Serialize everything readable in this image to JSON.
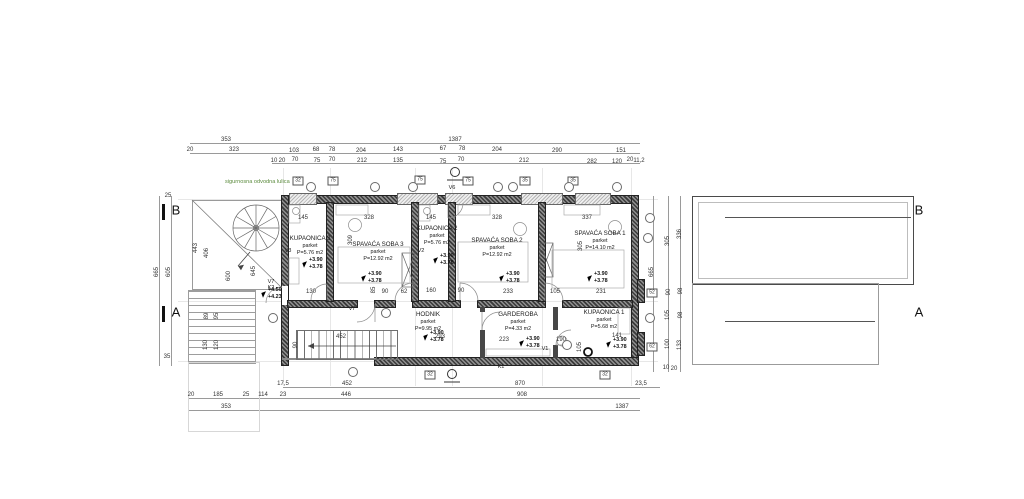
{
  "annotations": {
    "note": "sigurnosna odvodna lulica",
    "note_color": "#5a8a3c"
  },
  "colors": {
    "wall_hatch_dark": "#3b3b3b",
    "wall_hatch_light": "#909090",
    "dimension_text": "#333333",
    "axis_line": "#e7e7e7",
    "note_green": "#5a8a3c"
  },
  "rooms": [
    {
      "name": "KUPAONICA 3",
      "floor": "parket",
      "area": "P=5.76 m2",
      "cx": 310,
      "y": 236
    },
    {
      "name": "SPAVAĆA SOBA 3",
      "floor": "parket",
      "area": "P=12.92 m2",
      "cx": 378,
      "y": 242
    },
    {
      "name": "KUPAONICA 2",
      "floor": "parket",
      "area": "P=5.76 m2",
      "cx": 437,
      "y": 226
    },
    {
      "name": "SPAVAĆA SOBA 2",
      "floor": "parket",
      "area": "P=12.92 m2",
      "cx": 497,
      "y": 238
    },
    {
      "name": "SPAVAĆA SOBA 1",
      "floor": "parket",
      "area": "P=14.10 m2",
      "cx": 600,
      "y": 231
    },
    {
      "name": "GARDEROBA",
      "floor": "parket",
      "area": "P=4.33 m2",
      "cx": 518,
      "y": 312
    },
    {
      "name": "KUPAONICA 1",
      "floor": "parket",
      "area": "P=5.68 m2",
      "cx": 604,
      "y": 310
    },
    {
      "name": "HODNIK",
      "floor": "parket",
      "area": "P=9.95 m2",
      "cx": 428,
      "y": 312
    }
  ],
  "elevation_markers": [
    {
      "upper": "+3.90",
      "lower": "+3.78",
      "x": 303,
      "y": 262
    },
    {
      "upper": "+3.90",
      "lower": "+3.78",
      "x": 362,
      "y": 276
    },
    {
      "upper": "+3.90",
      "lower": "+3.78",
      "x": 434,
      "y": 258
    },
    {
      "upper": "+3.90",
      "lower": "+3.78",
      "x": 500,
      "y": 276
    },
    {
      "upper": "+3.90",
      "lower": "+3.78",
      "x": 588,
      "y": 276
    },
    {
      "upper": "+3.90",
      "lower": "+3.78",
      "x": 520,
      "y": 341
    },
    {
      "upper": "+3.90",
      "lower": "+3.78",
      "x": 607,
      "y": 342
    },
    {
      "upper": "+3.90",
      "lower": "+3.78",
      "x": 424,
      "y": 335
    },
    {
      "upper": "+4.50",
      "lower": "+4.23",
      "x": 262,
      "y": 292
    }
  ],
  "section_letters": [
    {
      "t": "B",
      "x": 176,
      "y": 210
    },
    {
      "t": "A",
      "x": 176,
      "y": 312
    },
    {
      "t": "B",
      "x": 919,
      "y": 210
    },
    {
      "t": "A",
      "x": 919,
      "y": 312
    }
  ],
  "dim_labels": [
    [
      "353",
      226,
      140
    ],
    [
      "1387",
      455,
      140
    ],
    [
      "20",
      190,
      150
    ],
    [
      "323",
      234,
      150
    ],
    [
      "103",
      294,
      151
    ],
    [
      "68",
      316,
      150
    ],
    [
      "78",
      332,
      150
    ],
    [
      "204",
      361,
      151
    ],
    [
      "143",
      398,
      150
    ],
    [
      "67",
      443,
      149
    ],
    [
      "78",
      462,
      149
    ],
    [
      "204",
      497,
      150
    ],
    [
      "290",
      557,
      151
    ],
    [
      "151",
      621,
      151
    ],
    [
      "10",
      274,
      161
    ],
    [
      "20",
      282,
      161
    ],
    [
      "70",
      295,
      160
    ],
    [
      "75",
      317,
      161
    ],
    [
      "70",
      332,
      160
    ],
    [
      "212",
      362,
      161
    ],
    [
      "135",
      398,
      161
    ],
    [
      "75",
      443,
      162
    ],
    [
      "70",
      461,
      160
    ],
    [
      "212",
      524,
      161
    ],
    [
      "282",
      592,
      162
    ],
    [
      "120",
      617,
      162
    ],
    [
      "20",
      630,
      160
    ],
    [
      "11,2",
      639,
      161
    ],
    [
      "17,5",
      283,
      384
    ],
    [
      "452",
      347,
      384
    ],
    [
      "870",
      520,
      384
    ],
    [
      "23,5",
      641,
      384
    ],
    [
      "20",
      191,
      395
    ],
    [
      "185",
      218,
      395
    ],
    [
      "25",
      246,
      395
    ],
    [
      "114",
      263,
      395
    ],
    [
      "23",
      283,
      395
    ],
    [
      "446",
      346,
      395
    ],
    [
      "908",
      522,
      395
    ],
    [
      "353",
      226,
      407
    ],
    [
      "1387",
      622,
      407
    ],
    [
      "665",
      157,
      272,
      1
    ],
    [
      "605",
      169,
      272,
      1
    ],
    [
      "25",
      168,
      196
    ],
    [
      "35",
      167,
      357
    ],
    [
      "443",
      196,
      248,
      1
    ],
    [
      "406",
      207,
      253,
      1
    ],
    [
      "600",
      229,
      276,
      1
    ],
    [
      "645",
      254,
      271,
      1
    ],
    [
      "89",
      207,
      316,
      1
    ],
    [
      "95",
      217,
      316,
      1
    ],
    [
      "130",
      206,
      345,
      1
    ],
    [
      "120",
      217,
      345,
      1
    ],
    [
      "665",
      652,
      272,
      1
    ],
    [
      "305",
      668,
      241,
      1
    ],
    [
      "90",
      669,
      292,
      1
    ],
    [
      "105",
      668,
      315,
      1
    ],
    [
      "100",
      668,
      344,
      1
    ],
    [
      "10",
      666,
      368
    ],
    [
      "336",
      680,
      234,
      1
    ],
    [
      "98",
      681,
      291,
      1
    ],
    [
      "98",
      681,
      315,
      1
    ],
    [
      "133",
      680,
      345,
      1
    ],
    [
      "20",
      674,
      369
    ],
    [
      "145",
      303,
      218
    ],
    [
      "328",
      369,
      218
    ],
    [
      "145",
      431,
      218
    ],
    [
      "328",
      497,
      218
    ],
    [
      "337",
      587,
      218
    ],
    [
      "309",
      351,
      240,
      1
    ],
    [
      "305",
      581,
      246,
      1
    ],
    [
      "130",
      311,
      292
    ],
    [
      "85",
      374,
      290,
      1
    ],
    [
      "90",
      385,
      292
    ],
    [
      "62",
      404,
      292
    ],
    [
      "160",
      431,
      291
    ],
    [
      "90",
      461,
      291
    ],
    [
      "233",
      508,
      292
    ],
    [
      "105",
      555,
      292
    ],
    [
      "231",
      601,
      292
    ],
    [
      "452",
      341,
      337
    ],
    [
      "293",
      440,
      337
    ],
    [
      "223",
      504,
      340
    ],
    [
      "190",
      561,
      340
    ],
    [
      "141",
      617,
      336
    ],
    [
      "105",
      580,
      347,
      1
    ],
    [
      "90",
      296,
      345,
      1
    ]
  ],
  "ref_labels": [
    [
      "V6",
      452,
      188
    ],
    [
      "V7",
      352,
      309
    ],
    [
      "V7",
      271,
      282
    ],
    [
      "K2",
      271,
      288
    ],
    [
      "V3",
      288,
      251
    ],
    [
      "V2",
      421,
      251
    ],
    [
      "V1",
      545,
      349
    ],
    [
      "K1",
      501,
      367
    ]
  ],
  "square_tags": [
    [
      "32",
      298,
      181
    ],
    [
      "75",
      333,
      181
    ],
    [
      "75",
      420,
      180
    ],
    [
      "75",
      468,
      181
    ],
    [
      "35",
      525,
      181
    ],
    [
      "35",
      573,
      181
    ],
    [
      "52",
      652,
      293
    ],
    [
      "62",
      652,
      347
    ],
    [
      "32",
      430,
      375
    ],
    [
      "32",
      605,
      375
    ]
  ],
  "circle_tags": [
    [
      311,
      187
    ],
    [
      375,
      187
    ],
    [
      413,
      187
    ],
    [
      498,
      187
    ],
    [
      513,
      187
    ],
    [
      569,
      187
    ],
    [
      617,
      187
    ],
    [
      650,
      218
    ],
    [
      648,
      238
    ],
    [
      650,
      318
    ],
    [
      353,
      372
    ],
    [
      386,
      313
    ],
    [
      567,
      345
    ],
    [
      273,
      318
    ]
  ]
}
